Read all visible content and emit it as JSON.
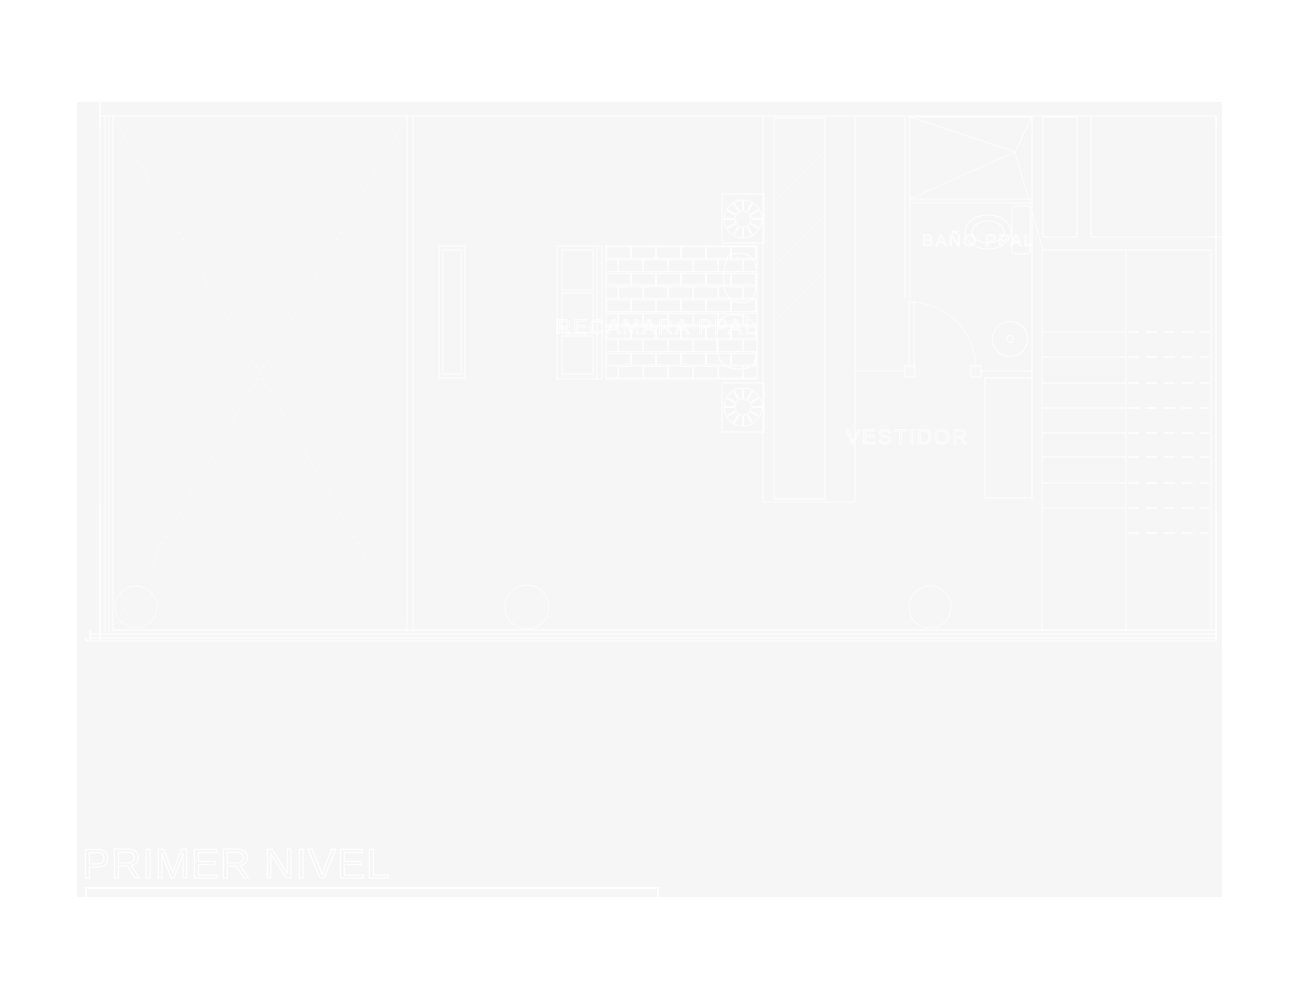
{
  "canvas": {
    "page_background": "#ffffff",
    "drawing_background": "#f6f6f6",
    "line_color": "#ffffff"
  },
  "plan": {
    "title": "PRIMER NIVEL",
    "labels": {
      "master_bedroom": "RECAMARA PPAL",
      "dressing_room": "VESTIDOR",
      "master_bathroom": "BAÑO PPAL"
    }
  }
}
